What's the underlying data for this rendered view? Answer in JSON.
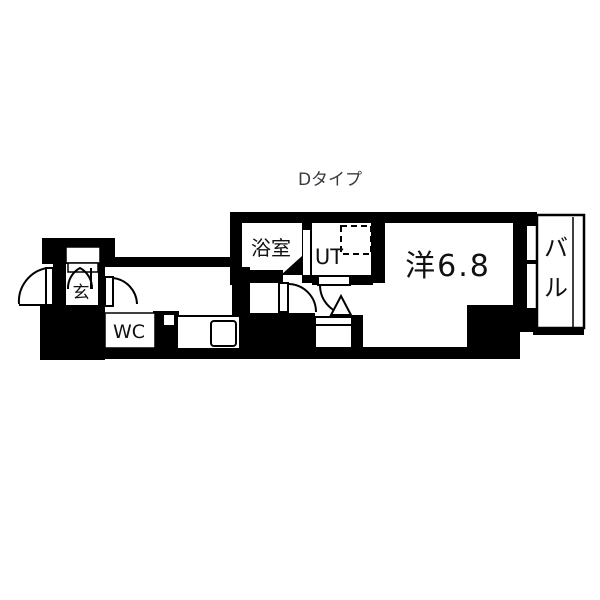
{
  "title": "Dタイプ",
  "plan": {
    "labels": {
      "bath": "浴室",
      "utility": "UT",
      "main_room": "洋6.8",
      "wc": "WC",
      "entrance": "玄",
      "balcony_chars": [
        "バ",
        "ル"
      ]
    },
    "colors": {
      "wall": "#000000",
      "floor": "#ffffff",
      "line": "#000000",
      "title_text": "#3a3a42",
      "label_text": "#111111"
    }
  }
}
